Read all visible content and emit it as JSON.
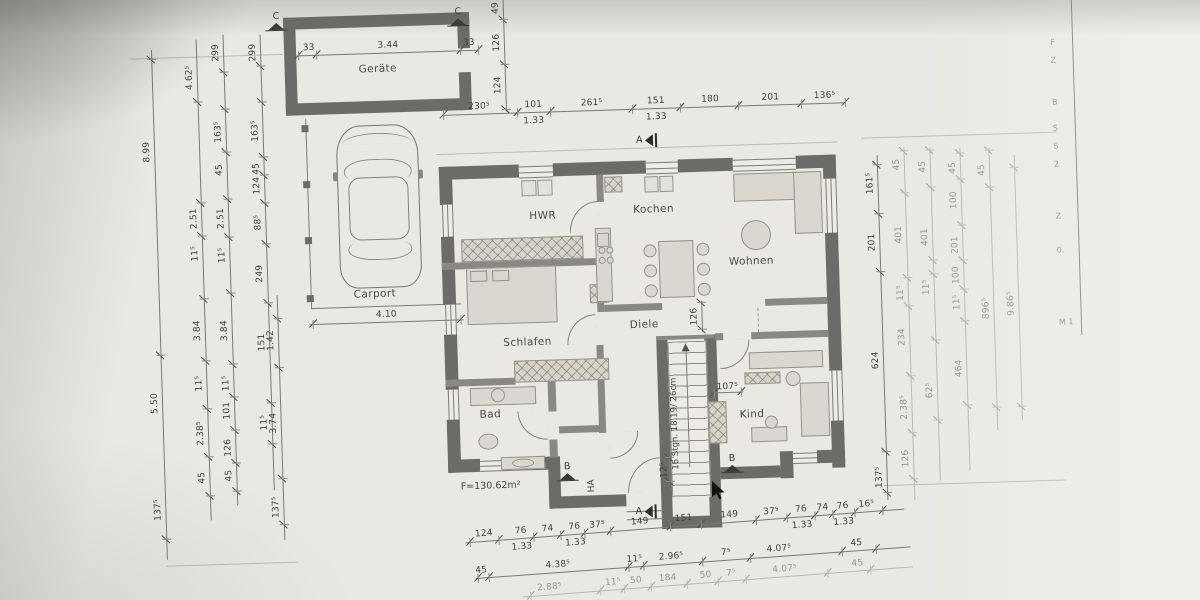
{
  "colors": {
    "paper": "#eae8e3",
    "wall_dark": "#6d6b67",
    "wall_mid": "#8a8883",
    "furniture_fill": "#dad7d0",
    "line": "#7b7974",
    "dim_text": "#403e3a",
    "faint_text": "#94928d"
  },
  "rooms": [
    {
      "id": "geraete",
      "label": "Geräte",
      "x": 366,
      "y": 56
    },
    {
      "id": "carport",
      "label": "Carport",
      "x": 354,
      "y": 281
    },
    {
      "id": "hwr",
      "label": "HWR",
      "x": 532,
      "y": 208
    },
    {
      "id": "kochen",
      "label": "Kochen",
      "x": 636,
      "y": 205
    },
    {
      "id": "wohnen",
      "label": "Wohnen",
      "x": 730,
      "y": 260
    },
    {
      "id": "schlafen",
      "label": "Schlafen",
      "x": 502,
      "y": 334
    },
    {
      "id": "diele",
      "label": "Diele",
      "x": 629,
      "y": 320
    },
    {
      "id": "bad",
      "label": "Bad",
      "x": 476,
      "y": 405
    },
    {
      "id": "kind",
      "label": "Kind",
      "x": 736,
      "y": 413
    }
  ],
  "annotations": {
    "area": "F=130.62m²",
    "stair_note": "16 Stgn. 18.19/ 26cm",
    "ha": "HA"
  },
  "markers": [
    {
      "letter": "C",
      "x": 274,
      "y": 2,
      "dir": "up"
    },
    {
      "letter": "C",
      "x": 456,
      "y": 3,
      "dir": "up"
    },
    {
      "letter": "A",
      "x": 641,
      "y": 135,
      "dir": "left"
    },
    {
      "letter": "A",
      "x": 629,
      "y": 506,
      "dir": "left"
    },
    {
      "letter": "B",
      "x": 551,
      "y": 461,
      "dir": "up"
    },
    {
      "letter": "B",
      "x": 716,
      "y": 458,
      "dir": "up"
    }
  ],
  "dim_chains": [
    {
      "id": "top-row",
      "x1": 449,
      "y1": 110,
      "x2": 851,
      "y2": 110,
      "ticks": [
        0,
        0.185,
        0.265,
        0.47,
        0.59,
        0.735,
        0.89,
        1
      ],
      "labels": [
        {
          "t": "230⁵",
          "f": 0.09
        },
        {
          "t": "101",
          "f": 0.225
        },
        {
          "t": "1.33",
          "f": 0.225,
          "o": 4
        },
        {
          "t": "261⁵",
          "f": 0.37
        },
        {
          "t": "151",
          "f": 0.53
        },
        {
          "t": "1.33",
          "f": 0.53,
          "o": 4
        },
        {
          "t": "180",
          "f": 0.665
        },
        {
          "t": "201",
          "f": 0.815
        },
        {
          "t": "136⁵",
          "f": 0.95
        }
      ]
    },
    {
      "id": "garage-row",
      "x1": 306,
      "y1": 46,
      "x2": 486,
      "y2": 46,
      "ticks": [
        0,
        0.1,
        0.9,
        1
      ],
      "labels": [
        {
          "t": "33",
          "f": 0.06
        },
        {
          "t": "3.44",
          "f": 0.5
        },
        {
          "t": "33",
          "f": 0.95
        }
      ]
    },
    {
      "id": "garage-col",
      "x1": 512,
      "y1": 109,
      "x2": 512,
      "y2": -3,
      "ticks": [
        0.02,
        0.42,
        0.82
      ],
      "labels": [
        {
          "t": "124",
          "f": 0.24
        },
        {
          "t": "126",
          "f": 0.62
        },
        {
          "t": "49",
          "f": 0.93
        }
      ]
    },
    {
      "id": "carport-row",
      "x1": 309,
      "y1": 315,
      "x2": 463,
      "y2": 315,
      "ticks": [
        0.02,
        0.98
      ],
      "labels": [
        {
          "t": "4.10",
          "f": 0.5
        }
      ]
    },
    {
      "id": "left-1",
      "x1": 159,
      "y1": 546,
      "x2": 159,
      "y2": 36,
      "ticks": [
        0.04,
        0.4,
        0.98
      ],
      "labels": [
        {
          "t": "137⁵",
          "f": 0.098
        },
        {
          "t": "5.50",
          "f": 0.307
        },
        {
          "t": "8.99",
          "f": 0.8
        }
      ]
    },
    {
      "id": "left-2",
      "x1": 204,
      "y1": 508,
      "x2": 204,
      "y2": 27,
      "ticks": [
        0.05,
        0.13,
        0.23,
        0.33,
        0.46,
        0.59,
        0.66,
        0.87
      ],
      "labels": [
        {
          "t": "45",
          "f": 0.089
        },
        {
          "t": "2.38⁵",
          "f": 0.181
        },
        {
          "t": "11⁵",
          "f": 0.285
        },
        {
          "t": "3.84",
          "f": 0.395
        },
        {
          "t": "11⁵",
          "f": 0.555
        },
        {
          "t": "2.51",
          "f": 0.628
        },
        {
          "t": "4.62⁵",
          "f": 0.921
        }
      ]
    },
    {
      "id": "left-3",
      "x1": 231,
      "y1": 494,
      "x2": 231,
      "y2": 23,
      "ticks": [
        0.03,
        0.09,
        0.16,
        0.23,
        0.3,
        0.45,
        0.57,
        0.65,
        0.75,
        0.84,
        0.92
      ],
      "labels": [
        {
          "t": "45",
          "f": 0.064
        },
        {
          "t": "126",
          "f": 0.123
        },
        {
          "t": "101",
          "f": 0.202
        },
        {
          "t": "11⁵",
          "f": 0.26
        },
        {
          "t": "3.84",
          "f": 0.372
        },
        {
          "t": "11⁵",
          "f": 0.532
        },
        {
          "t": "2.51",
          "f": 0.61
        },
        {
          "t": "45",
          "f": 0.713
        },
        {
          "t": "163⁵",
          "f": 0.794
        },
        {
          "t": "299",
          "f": 0.962
        }
      ]
    },
    {
      "id": "left-4",
      "x1": 268,
      "y1": 480,
      "x2": 268,
      "y2": 24,
      "ticks": [
        0.1,
        0.19,
        0.41,
        0.54,
        0.63,
        0.69,
        0.73,
        0.85,
        0.93
      ],
      "labels": [
        {
          "t": "11⁵",
          "f": 0.149
        },
        {
          "t": "151",
          "f": 0.325
        },
        {
          "t": "249",
          "f": 0.476
        },
        {
          "t": "88⁵",
          "f": 0.588
        },
        {
          "t": "124",
          "f": 0.669
        },
        {
          "t": "45",
          "f": 0.706
        },
        {
          "t": "163⁵",
          "f": 0.789
        },
        {
          "t": "299",
          "f": 0.961
        }
      ]
    },
    {
      "id": "left-5",
      "x1": 277,
      "y1": 530,
      "x2": 277,
      "y2": 285,
      "ticks": [
        0.06,
        0.25,
        0.7,
        0.9
      ],
      "labels": [
        {
          "t": "137⁵",
          "f": 0.135
        },
        {
          "t": "3.74",
          "f": 0.478
        },
        {
          "t": "1.42",
          "f": 0.816
        }
      ]
    },
    {
      "id": "right-1",
      "x1": 881,
      "y1": 509,
      "x2": 881,
      "y2": 164,
      "ticks": [
        0.02,
        0.14,
        0.66,
        0.83,
        0.97
      ],
      "labels": [
        {
          "t": "137⁵",
          "f": 0.067
        },
        {
          "t": "624",
          "f": 0.406
        },
        {
          "t": "201",
          "f": 0.748
        },
        {
          "t": "161⁵",
          "f": 0.919
        }
      ]
    },
    {
      "id": "right-2",
      "faint": true,
      "x1": 908,
      "y1": 510,
      "x2": 908,
      "y2": 157,
      "ticks": [
        0.06,
        0.19,
        0.35,
        0.55,
        0.63,
        0.87,
        0.99
      ],
      "labels": [
        {
          "t": "126",
          "f": 0.119
        },
        {
          "t": "2.38⁵",
          "f": 0.264
        },
        {
          "t": "234",
          "f": 0.463
        },
        {
          "t": "11⁵",
          "f": 0.588
        },
        {
          "t": "401",
          "f": 0.753
        },
        {
          "t": "45",
          "f": 0.952
        }
      ]
    },
    {
      "id": "right-3",
      "faint": true,
      "x1": 934,
      "y1": 491,
      "x2": 934,
      "y2": 158,
      "ticks": [
        0.18,
        0.42,
        0.62,
        0.66,
        0.88,
        0.99
      ],
      "labels": [
        {
          "t": "62⁵",
          "f": 0.271
        },
        {
          "t": "11⁵",
          "f": 0.581
        },
        {
          "t": "401",
          "f": 0.732
        },
        {
          "t": "45",
          "f": 0.943
        }
      ]
    },
    {
      "id": "right-4",
      "faint": true,
      "x1": 964,
      "y1": 482,
      "x2": 964,
      "y2": 159,
      "ticks": [
        0.2,
        0.46,
        0.56,
        0.65,
        0.76,
        0.9,
        0.98
      ],
      "labels": [
        {
          "t": "464",
          "f": 0.317
        },
        {
          "t": "11⁵",
          "f": 0.522
        },
        {
          "t": "100",
          "f": 0.606
        },
        {
          "t": "201",
          "f": 0.699
        },
        {
          "t": "100",
          "f": 0.838
        },
        {
          "t": "45",
          "f": 0.938
        }
      ]
    },
    {
      "id": "right-5",
      "faint": true,
      "x1": 993,
      "y1": 443,
      "x2": 993,
      "y2": 160,
      "ticks": [
        0.08,
        0.86,
        0.99
      ],
      "labels": [
        {
          "t": "896⁵",
          "f": 0.433
        },
        {
          "t": "45",
          "f": 0.922
        }
      ]
    },
    {
      "id": "right-6",
      "faint": true,
      "x1": 1018,
      "y1": 433,
      "x2": 1018,
      "y2": 168,
      "ticks": [
        0.05,
        0.95
      ],
      "labels": [
        {
          "t": "9.86⁵",
          "f": 0.44
        }
      ]
    },
    {
      "id": "bottom-1",
      "x1": 458,
      "y1": 538,
      "x2": 898,
      "y2": 518,
      "ticks": [
        0.01,
        0.075,
        0.155,
        0.215,
        0.27,
        0.33,
        0.465,
        0.535,
        0.66,
        0.73,
        0.795,
        0.835,
        0.885,
        0.95
      ],
      "labels": [
        {
          "t": "124",
          "f": 0.043
        },
        {
          "t": "76",
          "f": 0.127
        },
        {
          "t": "1.33",
          "f": 0.127,
          "o": 4
        },
        {
          "t": "74",
          "f": 0.188
        },
        {
          "t": "76",
          "f": 0.249
        },
        {
          "t": "1.33",
          "f": 0.249,
          "o": 4
        },
        {
          "t": "37⁵",
          "f": 0.301
        },
        {
          "t": "149",
          "f": 0.398
        },
        {
          "t": "151",
          "f": 0.498
        },
        {
          "t": "149",
          "f": 0.602
        },
        {
          "t": "37⁵",
          "f": 0.697
        },
        {
          "t": "76",
          "f": 0.765
        },
        {
          "t": "1.33",
          "f": 0.765,
          "o": 4
        },
        {
          "t": "74",
          "f": 0.814
        },
        {
          "t": "76",
          "f": 0.86
        },
        {
          "t": "1.33",
          "f": 0.86,
          "o": 4
        },
        {
          "t": "16⁵",
          "f": 0.914
        }
      ]
    },
    {
      "id": "bottom-2",
      "x1": 467,
      "y1": 574,
      "x2": 903,
      "y2": 556,
      "ticks": [
        0.005,
        0.03,
        0.35,
        0.385,
        0.52,
        0.63,
        0.84,
        0.92
      ],
      "labels": [
        {
          "t": "45",
          "f": 0.014
        },
        {
          "t": "4.38⁵",
          "f": 0.19
        },
        {
          "t": "11⁵",
          "f": 0.366
        },
        {
          "t": "2.96⁵",
          "f": 0.45
        },
        {
          "t": "7⁵",
          "f": 0.576
        },
        {
          "t": "4.07⁵",
          "f": 0.698
        },
        {
          "t": "45",
          "f": 0.876
        }
      ]
    },
    {
      "id": "bottom-3",
      "faint": true,
      "x1": 513,
      "y1": 594,
      "x2": 905,
      "y2": 576,
      "ticks": [
        0.02,
        0.2,
        0.26,
        0.33,
        0.42,
        0.5,
        0.57,
        0.78,
        0.89
      ],
      "labels": [
        {
          "t": "2.88⁵",
          "f": 0.071
        },
        {
          "t": "11⁵",
          "f": 0.233
        },
        {
          "t": "50",
          "f": 0.292
        },
        {
          "t": "184",
          "f": 0.373
        },
        {
          "t": "50",
          "f": 0.47
        },
        {
          "t": "7⁵",
          "f": 0.535
        },
        {
          "t": "4.07⁵",
          "f": 0.672
        },
        {
          "t": "45",
          "f": 0.858
        }
      ]
    },
    {
      "id": "stair-126",
      "x1": 701,
      "y1": 335,
      "x2": 701,
      "y2": 304,
      "ticks": [
        0.05,
        0.95
      ],
      "labels": [
        {
          "t": "126",
          "f": 0.5
        }
      ]
    },
    {
      "id": "dim-107",
      "x1": 709,
      "y1": 396,
      "x2": 740,
      "y2": 396,
      "ticks": [
        0.05,
        0.95
      ],
      "labels": [
        {
          "t": "107⁵",
          "f": 0.5,
          "o": -10
        }
      ]
    },
    {
      "id": "dim-12",
      "x1": 664,
      "y1": 486,
      "x2": 664,
      "y2": 458,
      "ticks": [
        0.08,
        0.92
      ],
      "labels": [
        {
          "t": "12⁵",
          "f": 0.5,
          "o": -10
        }
      ]
    }
  ],
  "title_block": {
    "edge_x": 1080,
    "fragments": [
      {
        "t": "F",
        "y": 52
      },
      {
        "t": "Z",
        "y": 70
      },
      {
        "t": "B",
        "y": 112
      },
      {
        "t": "S",
        "y": 138
      },
      {
        "t": "S",
        "y": 156
      },
      {
        "t": "2",
        "y": 174
      },
      {
        "t": "Z",
        "y": 226
      },
      {
        "t": "0.",
        "y": 260
      },
      {
        "t": "M 1",
        "y": 332
      }
    ]
  },
  "cursor": {
    "x": 712,
    "y": 481
  }
}
